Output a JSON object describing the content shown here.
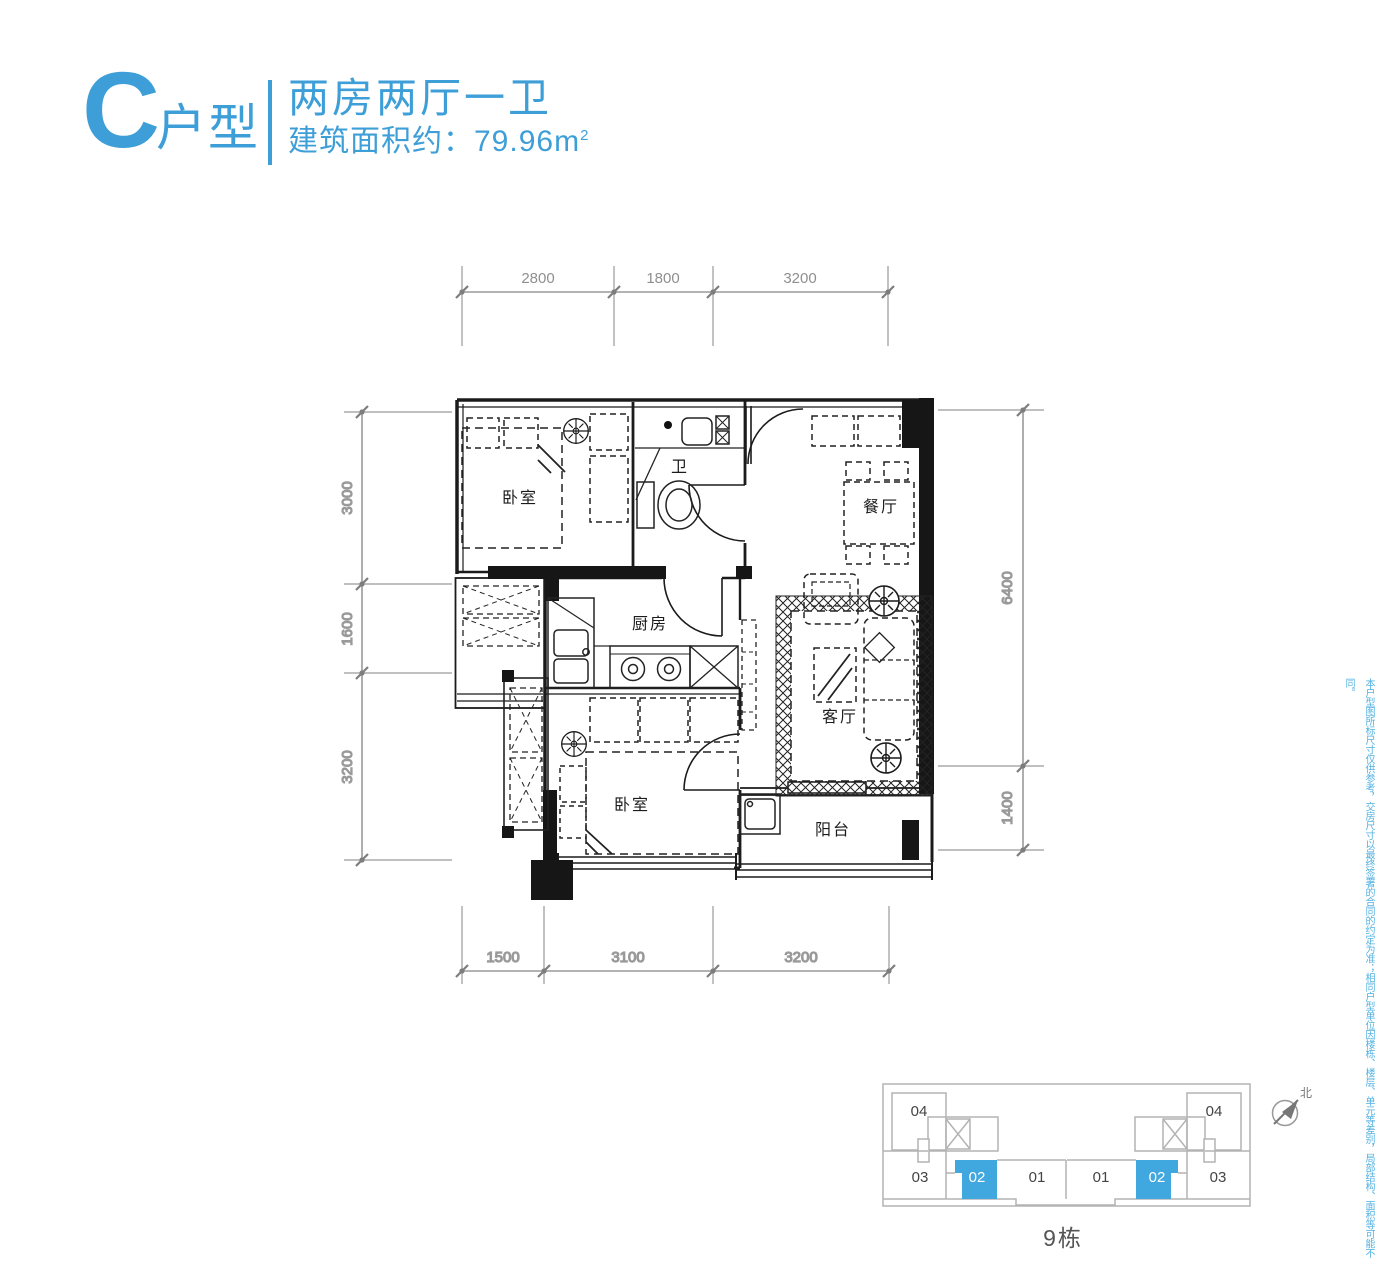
{
  "header": {
    "letter": "C",
    "suffix": "户型",
    "line1": "两房两厅一卫",
    "area_text": "建筑面积约：79.96m",
    "area_sup": "2"
  },
  "rooms": {
    "bedroom_top": "卧室",
    "bath": "卫",
    "dining": "餐厅",
    "kitchen": "厨房",
    "living": "客厅",
    "bedroom_bottom": "卧室",
    "balcony": "阳台"
  },
  "dims": {
    "top": [
      "2800",
      "1800",
      "3200"
    ],
    "bottom": [
      "1500",
      "3100",
      "3200"
    ],
    "left": [
      "3000",
      "1600",
      "3200"
    ],
    "right": [
      "6400",
      "1400"
    ]
  },
  "keyplan": {
    "caption": "9栋",
    "north": "北",
    "units": [
      "04",
      "03",
      "02",
      "01",
      "01",
      "02",
      "03",
      "04"
    ],
    "highlighted_unit": "02"
  },
  "disclaimer": "本户型图所标尺寸仅供参考，交房尺寸以最终签署的合同的约定为准；相同户型单位因楼栋、楼层、单元等差别，局部结构、面积等可能不同。",
  "colors": {
    "accent": "#3E9FD8",
    "keyplan_highlight": "#41A8DF",
    "disclaimer_text": "#54B1E1",
    "dimension_gray": "#8f8f8f",
    "plan_line": "#1b1b1b"
  }
}
